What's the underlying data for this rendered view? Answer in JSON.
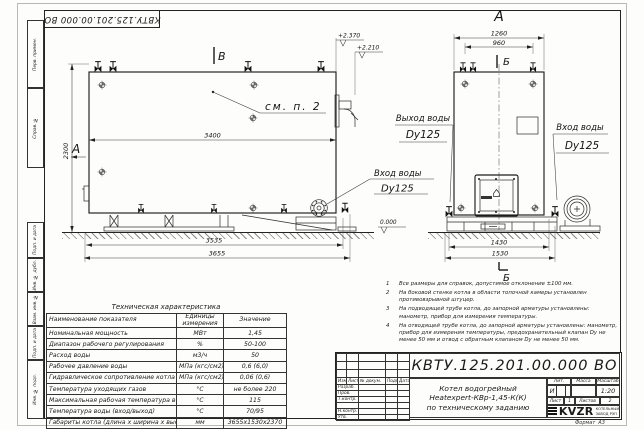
{
  "frame": {
    "left_labels": [
      "Перв. примен.",
      "Справ. №",
      "Подп. и дата",
      "Инв. № дубл.",
      "Взам. инв. №",
      "Подп. и дата",
      "Инв. № подл."
    ],
    "format_label": "Формат",
    "format_value": "А3"
  },
  "drawing": {
    "front_view": {
      "section_a": "А",
      "view_b_mark": "В",
      "callout_note": "см. п. 2",
      "dim_length": "3400",
      "dim_height": "2300",
      "dim_base": "3535",
      "dim_overall": "3655",
      "elev_top": "+2.370",
      "elev_mid": "+2.210",
      "inlet_title": "Вход воды",
      "inlet_size": "Dy125"
    },
    "side_view": {
      "view_title": "А",
      "section_b": "Б",
      "dim_top_overall": "1260",
      "dim_top_inner": "960",
      "dim_base_inner": "1430",
      "dim_base_overall": "1530",
      "elev_zero": "0.000",
      "outlet_title": "Выход воды",
      "outlet_size": "Dy125",
      "inlet_title": "Вход воды",
      "inlet_size": "Dy125"
    }
  },
  "notes": {
    "items": [
      {
        "num": "1",
        "text": "Все размеры для справок, допустимое отклонение ±100 мм."
      },
      {
        "num": "2",
        "text": "На боковой стенке котла в области топочной камеры установлен противовзрывной штуцер."
      },
      {
        "num": "3",
        "text": "На подводящей трубе котла, до запорной арматуры установлены: манометр, прибор для измерения температуры."
      },
      {
        "num": "4",
        "text": "На отводящей трубе котла, до запорной арматуры установлены: манометр, прибор для измерения температуры, предохранительный клапан Dу не менее 50 мм и отвод с обратным клапаном Dу не менее 50 мм."
      }
    ]
  },
  "spec_table": {
    "title": "Техническая характеристика",
    "headers": [
      "Наименование показателя",
      "Единицы измерения",
      "Значение"
    ],
    "rows": [
      [
        "Номинальная мощность",
        "МВт",
        "1,45"
      ],
      [
        "Диапазон рабочего регулирования",
        "%",
        "50-100"
      ],
      [
        "Расход воды",
        "м3/ч",
        "50"
      ],
      [
        "Рабочее давление воды",
        "МПа (кгс/см2)",
        "0,6 (6,0)"
      ],
      [
        "Гидравлическое сопротивление котла",
        "МПа (кгс/см2)",
        "0,06 (0,6)"
      ],
      [
        "Температура уходящих газов",
        "°С",
        "не более 220"
      ],
      [
        "Максимальная рабочая температура воды",
        "°С",
        "115"
      ],
      [
        "Температура воды (вход/выход)",
        "°С",
        "70/95"
      ],
      [
        "Габариты котла (длина х ширина х высота)",
        "мм",
        "3655х1530х2370"
      ]
    ]
  },
  "title_block": {
    "doc_number": "КВТУ.125.201.00.000 ВО",
    "desc_line1": "Котел водогрейный",
    "desc_line2": "Heatexpert-КВр-1,45-К(К)",
    "desc_line3": "по техническому заданию",
    "col_izm": "Изм.",
    "col_list": "Лист",
    "col_ndoc": "№ докум.",
    "col_podp": "Подп.",
    "col_data": "Дата",
    "row_razrab": "Разраб.",
    "row_prov": "Пров.",
    "row_tkontr": "Т.контр.",
    "row_nkontr": "Н.контр.",
    "row_utv": "Утв.",
    "lit_label": "Лит.",
    "lit_value": "И",
    "mass_label": "Масса",
    "scale_label": "Масштаб",
    "scale_value": "1:20",
    "sheet_label": "Лист",
    "sheet_value": "1",
    "sheets_label": "Листов",
    "sheets_value": "2",
    "logo_text": "KVZR",
    "company_line1": "КОТЕЛЬНЫЙ",
    "company_line2": "ЗАВОД РЭП"
  }
}
